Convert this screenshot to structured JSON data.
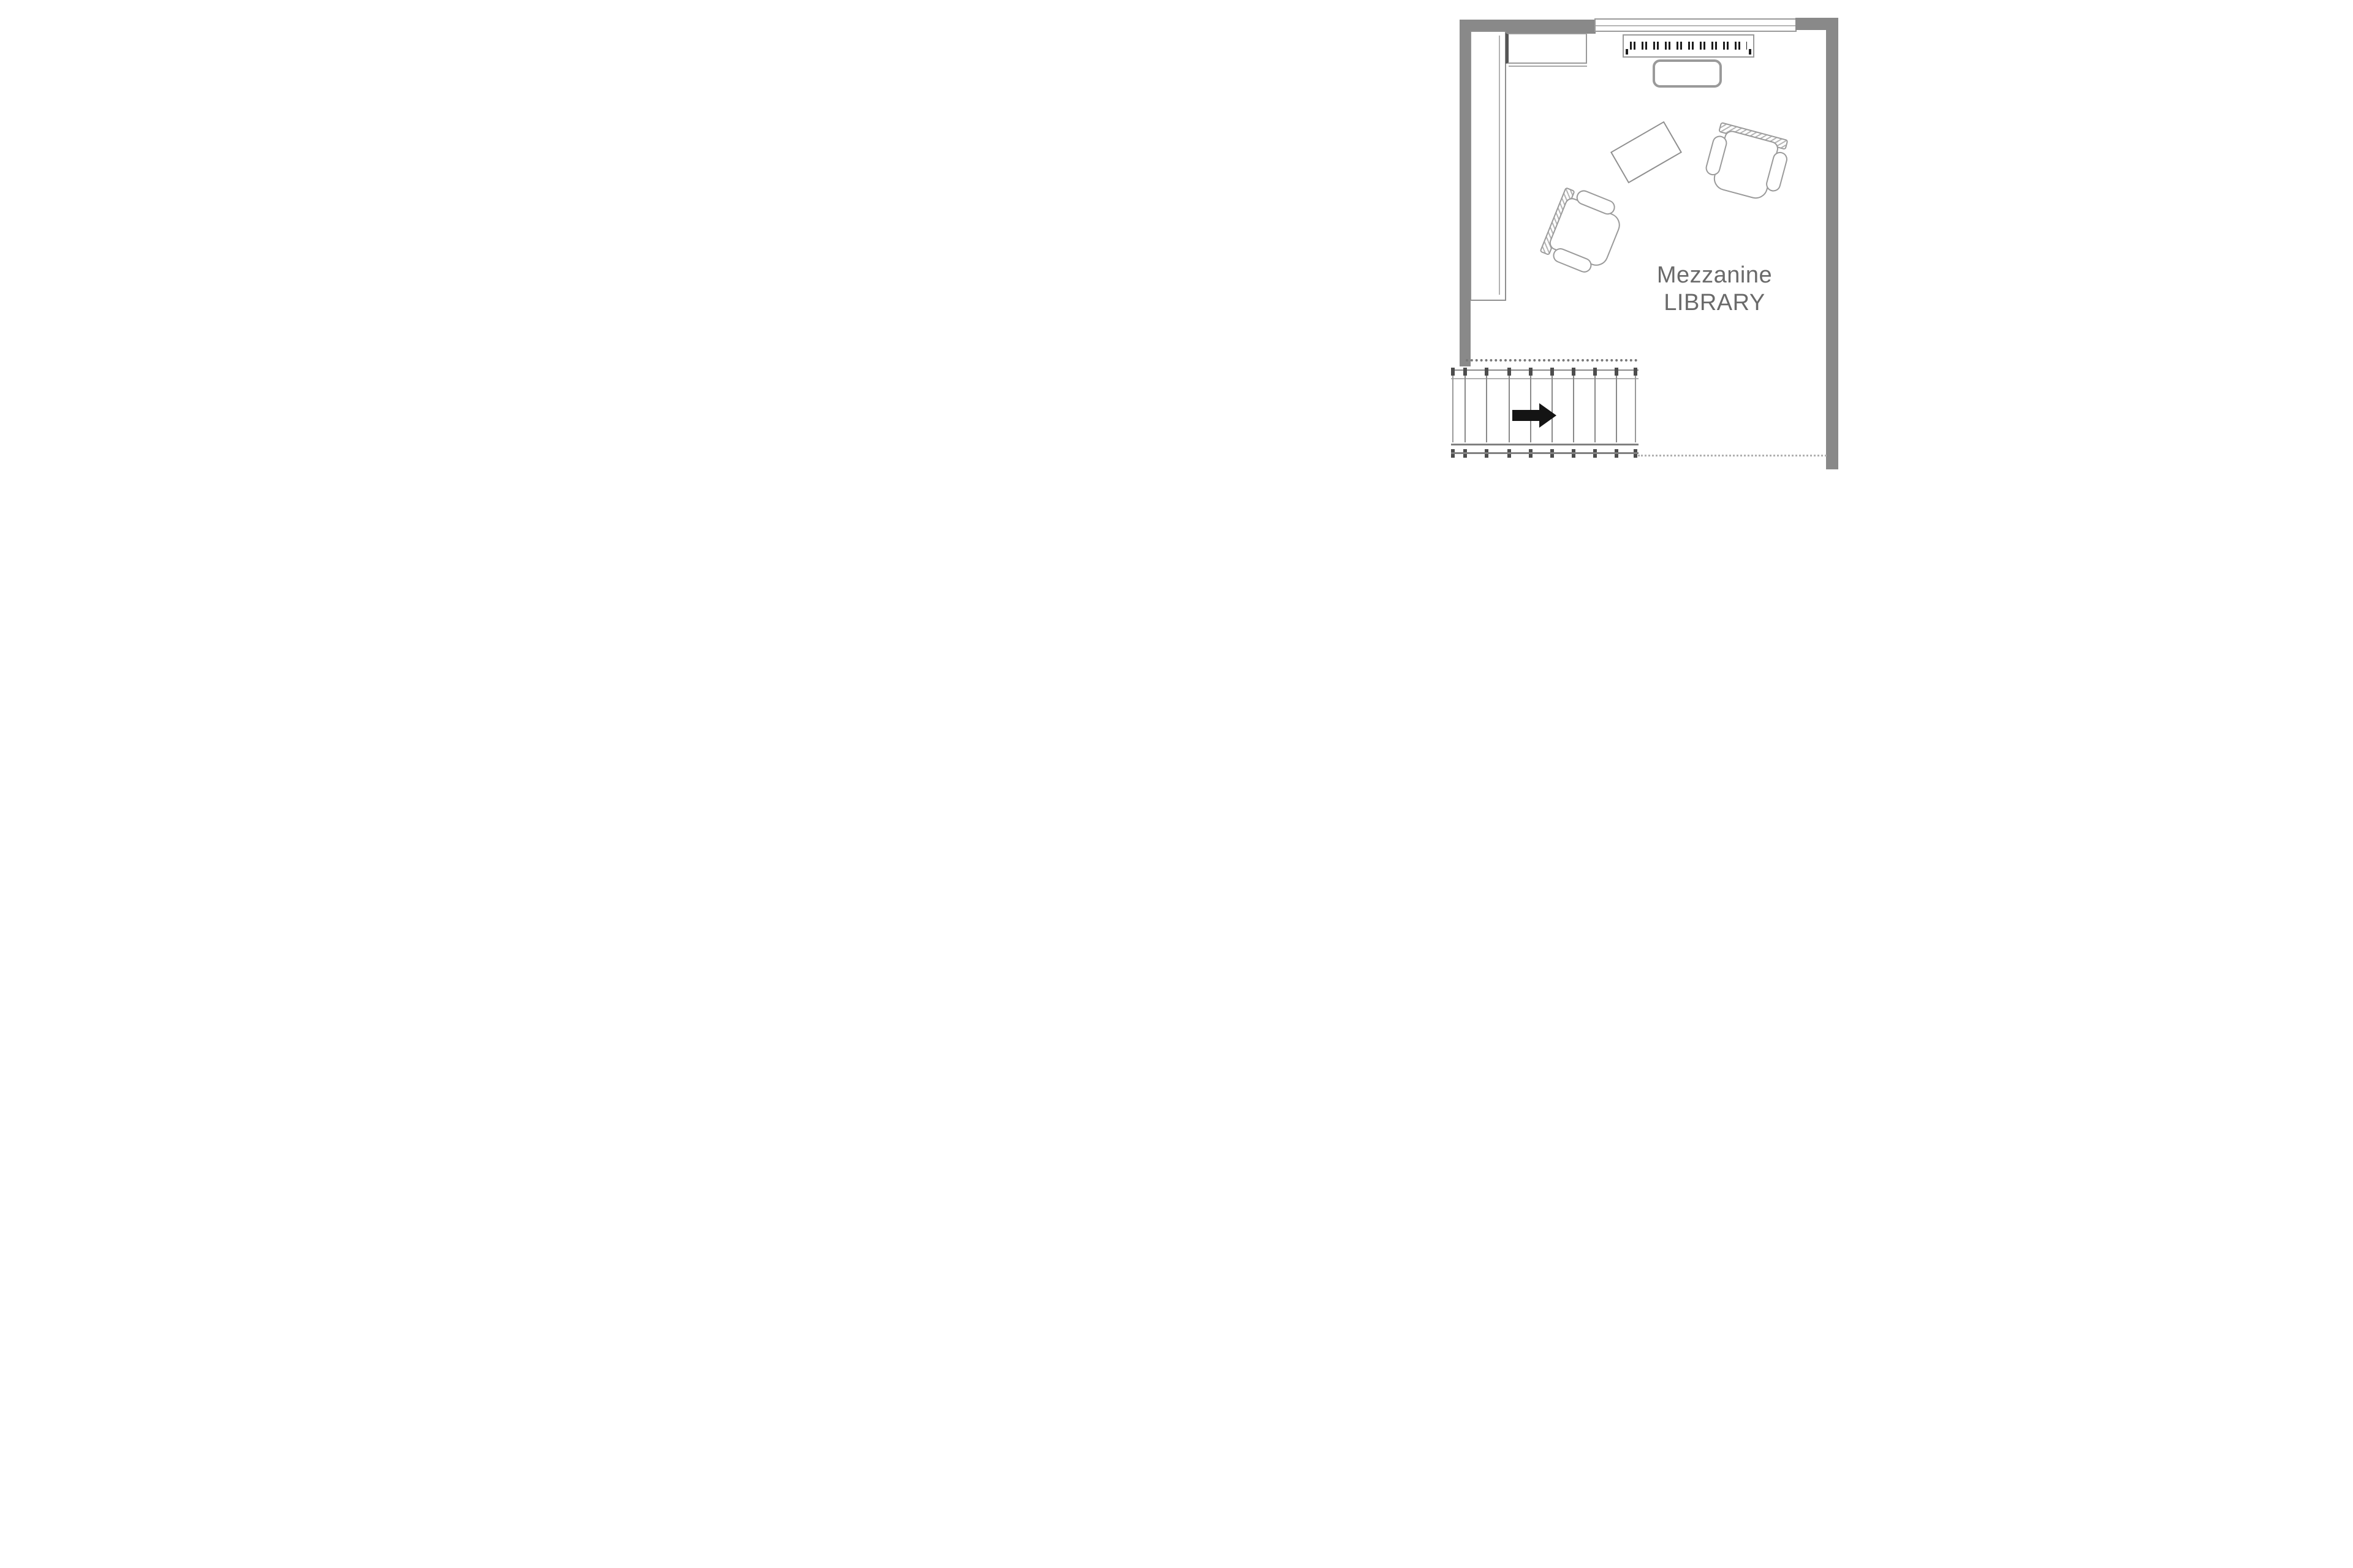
{
  "floorplan": {
    "room_label": {
      "line1": "Mezzanine",
      "line2": "LIBRARY"
    },
    "stairs": {
      "direction": "right",
      "tread_count": 9,
      "arrow_icon": "right-arrow-icon"
    },
    "furniture_icons": [
      "bookshelf-icon",
      "cabinet-icon",
      "shelving-unit-icon",
      "bench-icon",
      "side-table-icon",
      "armchair-icon",
      "armchair-icon"
    ],
    "colors": {
      "wall": "#898989",
      "furniture_line": "#9a9a9a",
      "label_text": "#6a6a6a",
      "arrow": "#141414",
      "background": "#ffffff"
    }
  }
}
